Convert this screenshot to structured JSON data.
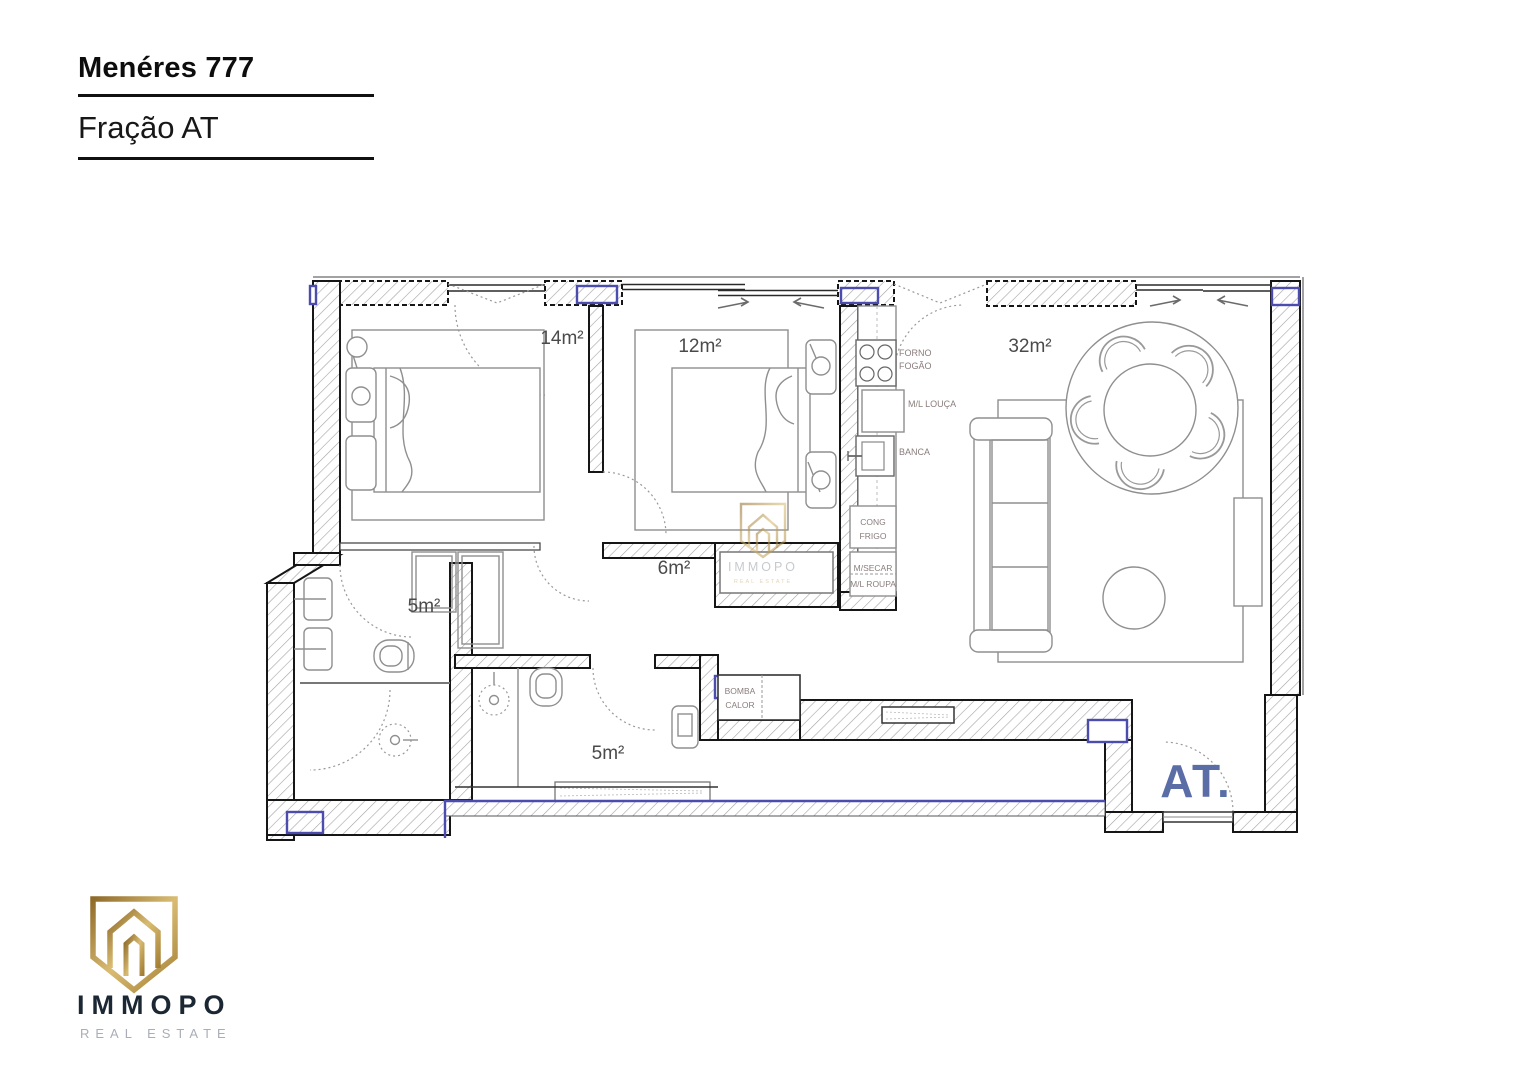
{
  "header": {
    "project_title": "Menéres 777",
    "fraction_title": "Fração AT"
  },
  "floorplan": {
    "rooms": [
      {
        "name": "bedroom-1",
        "area": "14m²"
      },
      {
        "name": "bedroom-2",
        "area": "12m²"
      },
      {
        "name": "living-room",
        "area": "32m²"
      },
      {
        "name": "hallway",
        "area": "6m²"
      },
      {
        "name": "bathroom-1",
        "area": "5m²"
      },
      {
        "name": "bathroom-2",
        "area": "5m²"
      }
    ],
    "kitchen": {
      "forno": "FORNO",
      "fogao": "FOGÃO",
      "ml_louca": "M/L LOUÇA",
      "banca": "BANCA",
      "cong": "CONG",
      "frigo": "FRIGO",
      "m_secar": "M/SECAR",
      "ml_roupa": "M/L ROUPA"
    },
    "utility": {
      "bomba": "BOMBA",
      "calor": "CALOR"
    },
    "unit_label": "AT.",
    "colors": {
      "column_purple": "#4c4cae",
      "unit_blue": "#5a6da6",
      "wall_hatch": "#a3a3a3"
    }
  },
  "watermark": {
    "brand": "IMMOPO",
    "tagline": "REAL ESTATE"
  },
  "logo": {
    "brand": "IMMOPO",
    "tagline": "REAL ESTATE",
    "gold": "#b6934a",
    "navy": "#1c2734",
    "gray": "#a9aeb6"
  }
}
